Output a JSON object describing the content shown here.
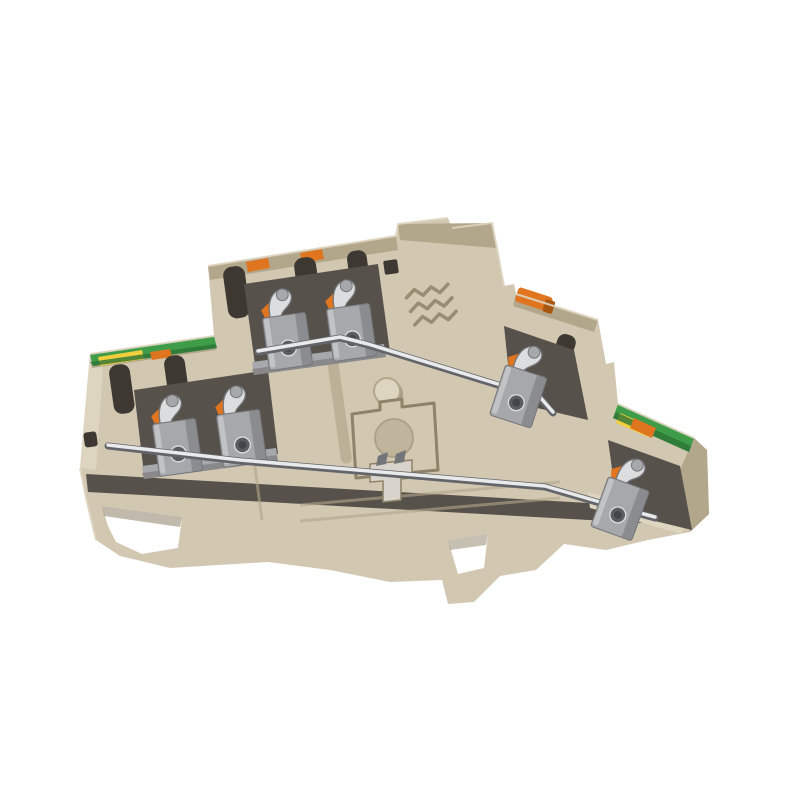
{
  "scene": {
    "type": "product-photo",
    "background_plain": true,
    "subject": "double-level din-rail terminal block"
  },
  "colors": {
    "background": "#ffffff",
    "housing": "#d2c8b2",
    "housingLight": "#ded5c0",
    "housingDark": "#b2a68b",
    "housingDeep": "#8e8268",
    "cavity": "#56514a",
    "slot": "#3d3932",
    "metal": "#a7a8ab",
    "metalLight": "#dcdddf",
    "metalDark": "#747578",
    "rod": "#e9eaeb",
    "rodEdge": "#63656a",
    "orange": "#e0751f",
    "orangeDark": "#a85612",
    "green": "#3f9d49",
    "greenDark": "#2c7636",
    "yellow": "#f1ce3e"
  },
  "parts": [
    "upper-level-housing",
    "lower-level-housing",
    "center-tower",
    "din-rail-foot",
    "pe-marking-strip-left",
    "pe-marking-strip-right",
    "push-in-clamp-upper-left-a",
    "push-in-clamp-upper-left-b",
    "push-in-clamp-lower-left-a",
    "push-in-clamp-lower-left-b",
    "push-in-clamp-right-upper",
    "push-in-clamp-right-lower",
    "orange-actuators",
    "busbar-upper",
    "busbar-lower",
    "manufacturer-logo-emboss",
    "center-stud",
    "keyhole-recess",
    "slider-clip"
  ]
}
